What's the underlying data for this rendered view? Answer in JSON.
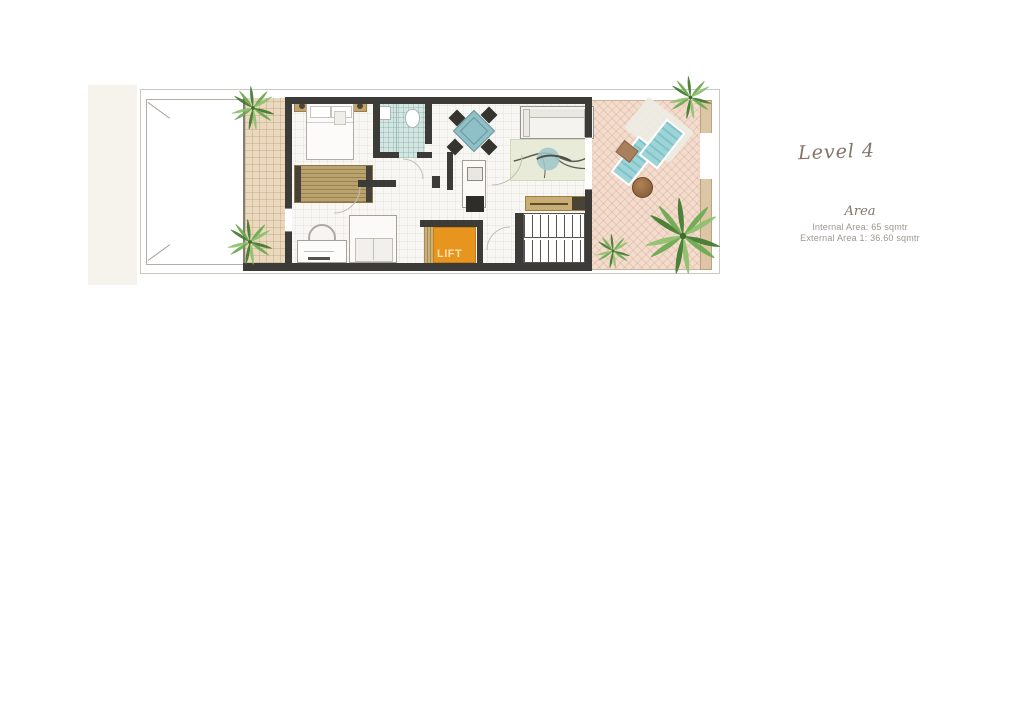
{
  "annotations": {
    "level_label": "Level 4",
    "area_heading": "Area",
    "internal_area": "Internal Area: 65 sqmtr",
    "external_area": "External Area 1: 36.60 sqmtr"
  },
  "plan": {
    "lift_label": "LIFT",
    "colors": {
      "wall": "#3c3b38",
      "lift_orange": "#e8951f",
      "terrace_left_tile": "#ebd9bf",
      "terrace_right_tile": "#f2dccd",
      "bathroom_tile": "#d3e6e2",
      "wood": "#c0a46c",
      "accent_teal": "#8fbfc7",
      "plant_green": "#5f9a44",
      "script_text": "#84746a",
      "small_text": "#9d968e"
    }
  }
}
